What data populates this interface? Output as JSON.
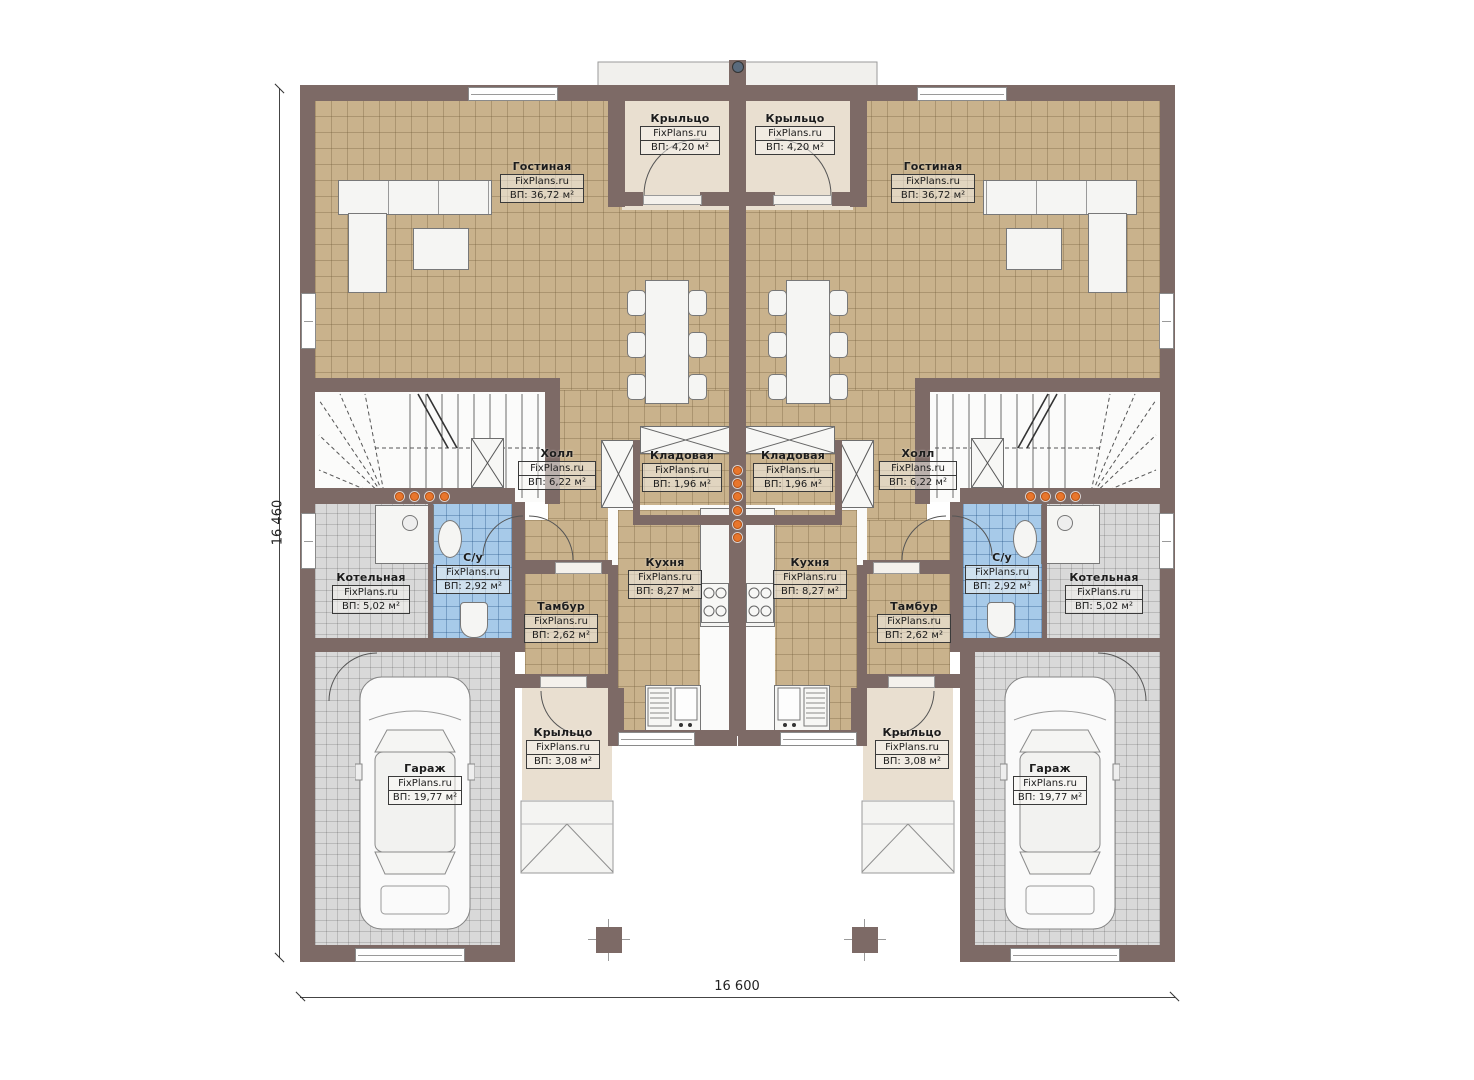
{
  "watermark": "FixPlans.ru",
  "dimensions": {
    "left": "16 460",
    "bottom": "16 600"
  },
  "rooms": [
    {
      "name": "Гостиная",
      "area": "ВП: 36,72 м²"
    },
    {
      "name": "Крыльцо",
      "area": "ВП: 4,20 м²"
    },
    {
      "name": "Холл",
      "area": "ВП: 6,22 м²"
    },
    {
      "name": "Кладовая",
      "area": "ВП: 1,96 м²"
    },
    {
      "name": "С/у",
      "area": "ВП: 2,92 м²"
    },
    {
      "name": "Котельная",
      "area": "ВП: 5,02 м²"
    },
    {
      "name": "Кухня",
      "area": "ВП: 8,27 м²"
    },
    {
      "name": "Тамбур",
      "area": "ВП: 2,62 м²"
    },
    {
      "name": "Крыльцо",
      "area": "ВП: 3,08 м²"
    },
    {
      "name": "Гараж",
      "area": "ВП: 19,77 м²"
    }
  ],
  "colors": {
    "wall": "#7d6a66",
    "floor_tan": "#c9b28c",
    "floor_gray": "#d9d9d9",
    "floor_blue": "#a7cae9",
    "floor_beige": "#e9dfd0",
    "accent_orange": "#e8762c"
  }
}
